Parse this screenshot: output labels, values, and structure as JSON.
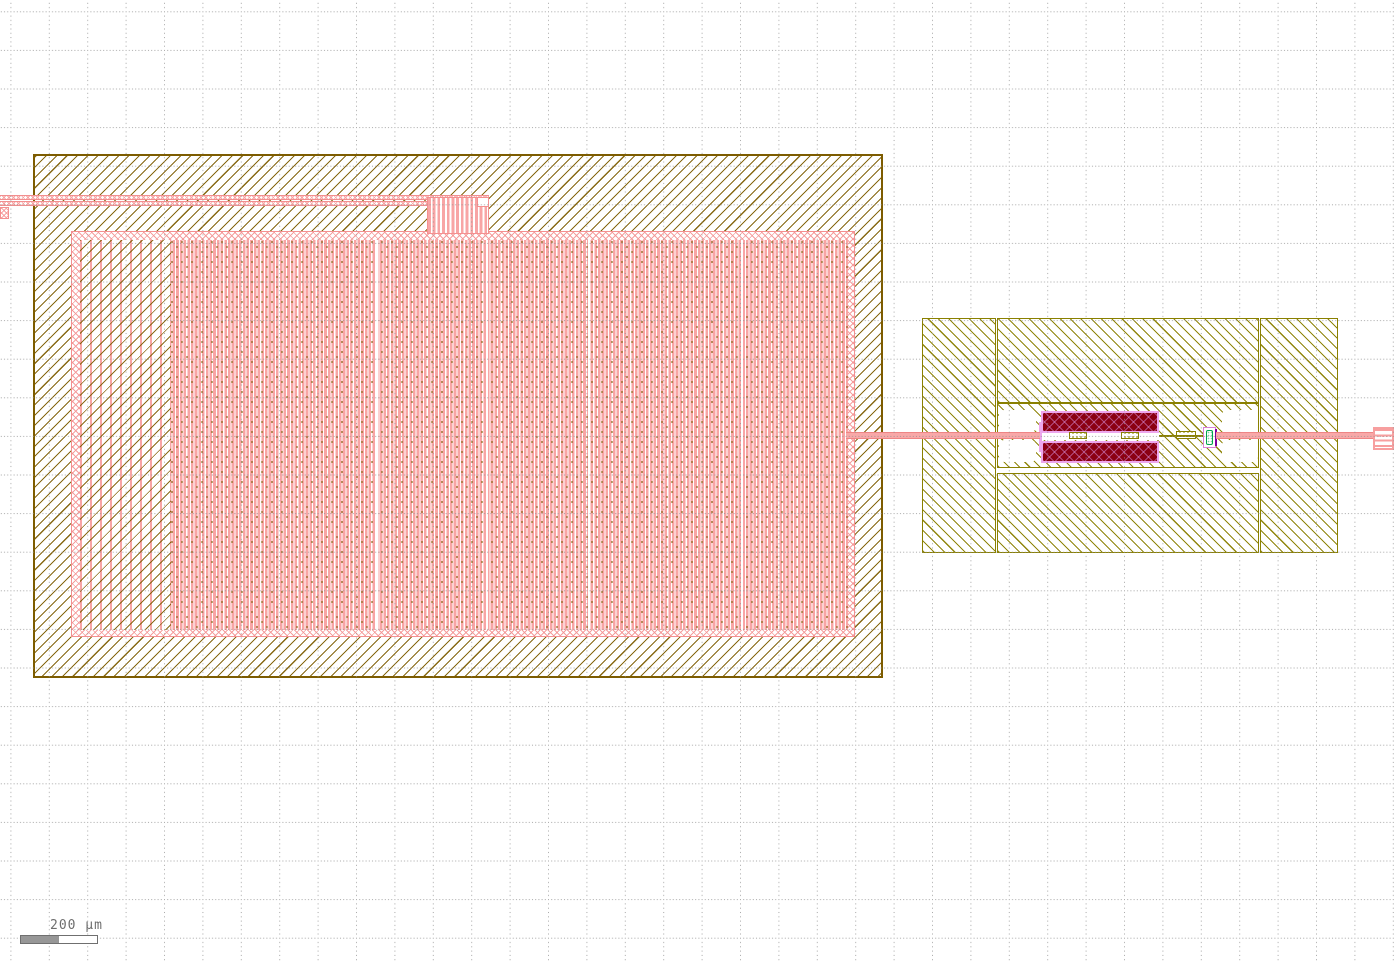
{
  "viewer": {
    "scale_bar": {
      "label": "200 µm",
      "bar_fill_color": "#979797",
      "outline_color": "#6f6f6f"
    },
    "grid": {
      "style": "dotted",
      "spacing_px": 38.5,
      "dot_color": "#909090"
    }
  },
  "layers": {
    "left_block_hatch": "#7d5c00",
    "right_module_hatch": "#8a8000",
    "pink_metal": "#f8a5a5",
    "pink_trace_edge": "#ee8585",
    "maroon_plate_fill": "#8b0012",
    "maroon_plate_hatch": "#d68ad6",
    "violet_border": "#eda6ed",
    "green_via": "#00a44c",
    "purple_mark": "#8000a0",
    "background": "#ffffff"
  },
  "structures": {
    "left_block": {
      "kind": "large hatched block with pink mesh interior",
      "mesh_separator_count": 4,
      "has_top_feed_trace": true
    },
    "right_module": {
      "kind": "device module with twin maroon plates",
      "contact_pad_count": 4,
      "via_count": 3,
      "has_green_via_marker": true
    },
    "interconnect": {
      "kind": "pink trace joining left block, module and right-edge pin"
    },
    "right_edge_pin": {
      "kind": "pink pin/port marker at canvas edge"
    }
  }
}
